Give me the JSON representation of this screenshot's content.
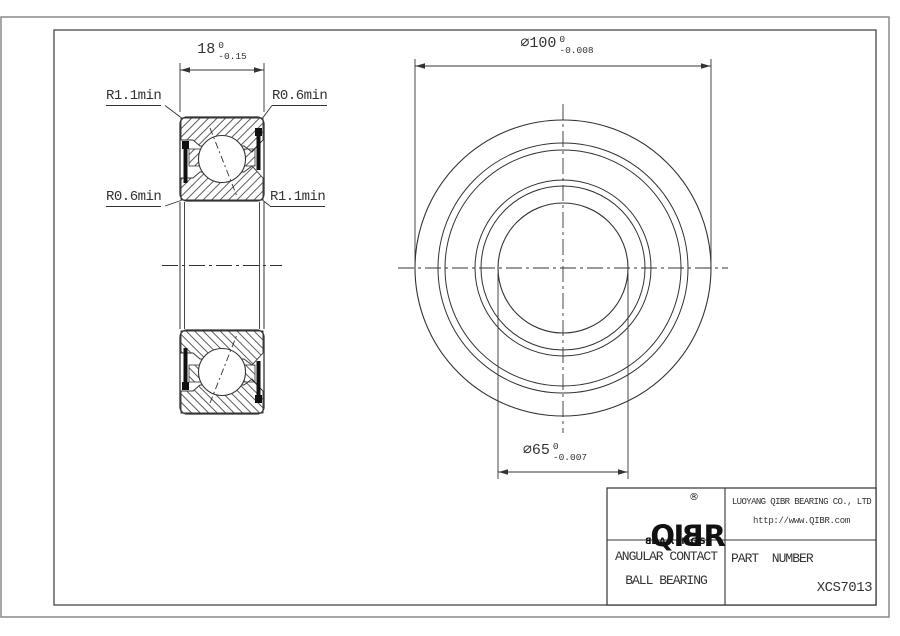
{
  "colors": {
    "line": "#333333",
    "seal_fill": "#111111",
    "frame": "#555555",
    "sheet_border": "#888888",
    "background": "#ffffff"
  },
  "section_view": {
    "width_dim": {
      "nominal": "18",
      "tol_upper": "0",
      "tol_lower": "-0.15"
    },
    "fillet_labels": {
      "top_left": "R1.1min",
      "top_right": "R0.6min",
      "bottom_left": "R0.6min",
      "bottom_right": "R1.1min"
    }
  },
  "front_view": {
    "outer_dia_dim": {
      "symbol": "∅",
      "nominal": "100",
      "tol_upper": "0",
      "tol_lower": "-0.008"
    },
    "bore_dia_dim": {
      "symbol": "∅",
      "nominal": "65",
      "tol_upper": "0",
      "tol_lower": "-0.007"
    }
  },
  "title_block": {
    "logo": {
      "part1": "QI",
      "mirrored_letter": "B",
      "part2": "R",
      "registered_mark": "®",
      "sub_part1": "B",
      "sub_part2": "EARINGS"
    },
    "company_name": "LUOYANG QIBR BEARING CO., LTD",
    "website": "http://www.QIBR.com",
    "product_type_line1": "ANGULAR CONTACT",
    "product_type_line2": "BALL BEARING",
    "part_number_label": "PART  NUMBER",
    "part_number_value": "XCS7013"
  }
}
